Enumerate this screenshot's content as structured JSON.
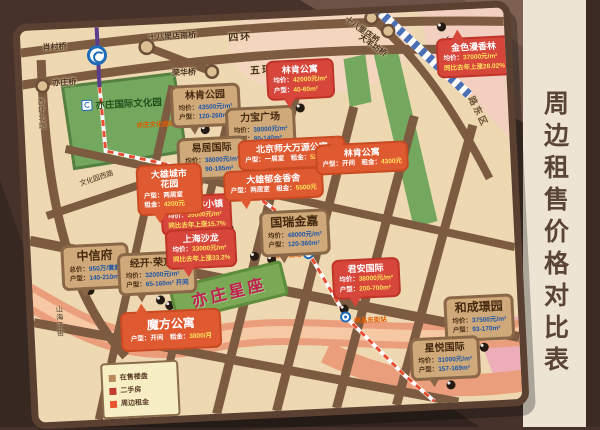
{
  "side_panel": {
    "title": "周边租售价格对比表"
  },
  "featured": {
    "name": "亦庄星座"
  },
  "legend": {
    "items": [
      {
        "label": "在售楼盘",
        "color": "#b98a5e"
      },
      {
        "label": "二手房",
        "color": "#c23b2e"
      },
      {
        "label": "周边租金",
        "color": "#e8542f"
      }
    ]
  },
  "map_texts": {
    "bridges": [
      "肖村桥",
      "十八里店南桥",
      "四环",
      "五环",
      "荣华桥",
      "亦庄桥",
      "十八里店桥",
      "大羊坊桥"
    ],
    "roads": [
      "西环北路",
      "文化园西路",
      "荣华南路",
      "荣京东街",
      "山海子街"
    ],
    "area": "路东区",
    "railway": "城际铁路",
    "park": {
      "name": "亦庄国际文化园",
      "station": "亦庄文化园站"
    },
    "stations": [
      "荣京东街站",
      "荣昌东街站"
    ]
  },
  "colors": {
    "onsale_callout": "#cfa97a",
    "secondhand_callout": "#d7463b",
    "rent_callout": "#e05a31",
    "park_green": "#74a85e",
    "river_salmon": "#eb9e7b",
    "metro_purple": "#5b3d8f",
    "metro_dashed_red": "#e84b30",
    "value_blue": "#1f57a8",
    "value_yellow": "#ffe15c"
  },
  "callouts": [
    {
      "category": "在售楼盘",
      "title": "林肯公园",
      "lines": [
        {
          "k": "均价：",
          "v": "43500元/m²"
        },
        {
          "k": "户型：",
          "v": "120-260m²"
        }
      ]
    },
    {
      "category": "在售楼盘",
      "title": "力宝广场",
      "lines": [
        {
          "k": "均价：",
          "v": "38000元/m²"
        },
        {
          "k": "户型：",
          "v": "80-140m²"
        }
      ]
    },
    {
      "category": "在售楼盘",
      "title": "易居国际",
      "lines": [
        {
          "k": "均价：",
          "v": "38000元/m²"
        },
        {
          "k": "户型：",
          "v": "90-185m²"
        }
      ]
    },
    {
      "category": "在售楼盘",
      "title": "中信府",
      "lines": [
        {
          "k": "总价：",
          "v": "950万/套起"
        },
        {
          "k": "户型：",
          "v": "140-210m²"
        }
      ]
    },
    {
      "category": "在售楼盘",
      "title": "经开·荣京道",
      "lines": [
        {
          "k": "均价：",
          "v": "32000元/m²"
        },
        {
          "k": "户型：",
          "v": "65-160m² 开间"
        }
      ]
    },
    {
      "category": "在售楼盘",
      "title": "国瑞金嘉",
      "lines": [
        {
          "k": "均价：",
          "v": "48000元/m²"
        },
        {
          "k": "户型：",
          "v": "120-360m²"
        }
      ]
    },
    {
      "category": "在售楼盘",
      "title": "和成璟园",
      "lines": [
        {
          "k": "均价：",
          "v": "37500元/m²"
        },
        {
          "k": "户型：",
          "v": "93-170m²"
        }
      ]
    },
    {
      "category": "在售楼盘",
      "title": "星悦国际",
      "lines": [
        {
          "k": "均价：",
          "v": "31000元/m²"
        },
        {
          "k": "户型：",
          "v": "157-169m²"
        }
      ]
    },
    {
      "category": "二手房",
      "title": "林肯公寓",
      "lines": [
        {
          "k": "均价：",
          "v": "42000元/m²"
        },
        {
          "k": "户型：",
          "v": "40-60m²"
        }
      ]
    },
    {
      "category": "二手房",
      "title": "金色漫香林",
      "lines": [
        {
          "k": "均价：",
          "v": "37000元/m²"
        },
        {
          "k": "",
          "v": "同比去年上涨28.02%"
        }
      ]
    },
    {
      "category": "二手房",
      "title": "金地格林小镇",
      "lines": [
        {
          "k": "均价：",
          "v": "35000元/m²"
        },
        {
          "k": "",
          "v": "同比去年上涨15.7%"
        }
      ]
    },
    {
      "category": "二手房",
      "title": "上海沙龙",
      "lines": [
        {
          "k": "均价：",
          "v": "33000元/m²"
        },
        {
          "k": "",
          "v": "同比去年上涨33.2%"
        }
      ]
    },
    {
      "category": "二手房",
      "title": "君安国际",
      "lines": [
        {
          "k": "均价：",
          "v": "38000元/m²"
        },
        {
          "k": "户型：",
          "v": "200-700m²"
        }
      ]
    },
    {
      "category": "周边租金",
      "title": "北京师大万源公寓",
      "lines": [
        {
          "k": "户型：一居室　租金：",
          "v": "5200元/月"
        }
      ]
    },
    {
      "category": "周边租金",
      "title": "大雄郁金香舍",
      "lines": [
        {
          "k": "户型：两居室　租金：",
          "v": "5500元"
        }
      ]
    },
    {
      "category": "周边租金",
      "title": "林肯公寓",
      "lines": [
        {
          "k": "户型：开间　租金：",
          "v": "4300元"
        }
      ]
    },
    {
      "category": "周边租金",
      "title": "大雄城市\n花园",
      "lines": [
        {
          "k": "户型：两居室",
          "v": ""
        },
        {
          "k": "租金：",
          "v": "4200元"
        }
      ]
    },
    {
      "category": "周边租金",
      "title": "魔方公寓",
      "lines": [
        {
          "k": "户型：开间　租金：",
          "v": "3800/月"
        }
      ]
    }
  ]
}
